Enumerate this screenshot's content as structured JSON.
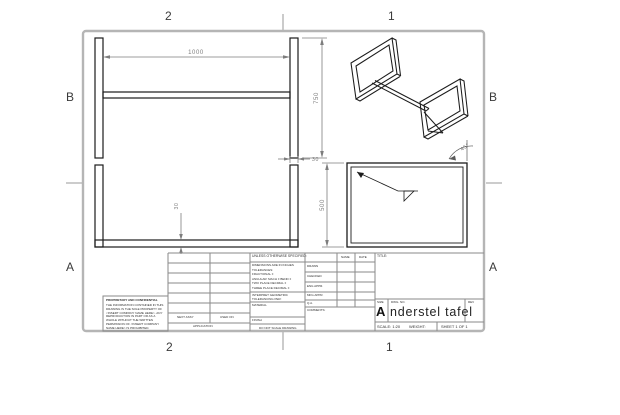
{
  "colors": {
    "paper": "#ffffff",
    "sheet_border": "#b5b5b5",
    "drawing_line": "#1c1c1c",
    "dimension_gray": "#7d7d7d",
    "titleblock_line": "#8a8a8a"
  },
  "zones": {
    "top": [
      "2",
      "1"
    ],
    "bottom": [
      "2",
      "1"
    ],
    "left": [
      "B",
      "A"
    ],
    "right": [
      "B",
      "A"
    ]
  },
  "dimensions": {
    "front_width": "1000",
    "front_height": "750",
    "leg_width": "30",
    "bar_width": "30",
    "side_depth": "500",
    "miter_angle": "45°"
  },
  "title_block": {
    "proprietary": {
      "heading": "PROPRIETARY AND CONFIDENTIAL",
      "body": "THE INFORMATION CONTAINED IN THIS DRAWING IS THE SOLE PROPERTY OF <INSERT COMPANY NAME HERE>. ANY REPRODUCTION IN PART OR AS A WHOLE WITHOUT THE WRITTEN PERMISSION OF <INSERT COMPANY NAME HERE> IS PROHIBITED."
    },
    "application": {
      "next_assy": "NEXT ASSY",
      "used_on": "USED ON",
      "label": "APPLICATION"
    },
    "tolerance_block": {
      "header": "UNLESS OTHERWISE SPECIFIED:",
      "lines": [
        "DIMENSIONS ARE IN INCHES",
        "TOLERANCES:",
        "FRACTIONAL ±",
        "ANGULAR: MACH ±  BEND ±",
        "TWO PLACE DECIMAL    ±",
        "THREE PLACE DECIMAL  ±"
      ],
      "interpret": "INTERPRET GEOMETRIC TOLERANCING PER:",
      "material_label": "MATERIAL",
      "finish_label": "FINISH",
      "do_not_scale": "DO NOT SCALE DRAWING"
    },
    "approval": {
      "name_header": "NAME",
      "date_header": "DATE",
      "rows": [
        "DRAWN",
        "CHECKED",
        "ENG APPR.",
        "MFG APPR.",
        "Q.A.",
        "COMMENTS:"
      ]
    },
    "title_label": "TITLE:",
    "size_label": "SIZE",
    "dwg_no_label": "DWG.  NO.",
    "rev_label": "REV",
    "size_value": "A",
    "dwg_no_value": "nderstel tafel",
    "scale": "SCALE: 1:20",
    "weight": "WEIGHT:",
    "sheet": "SHEET 1 OF 1"
  }
}
